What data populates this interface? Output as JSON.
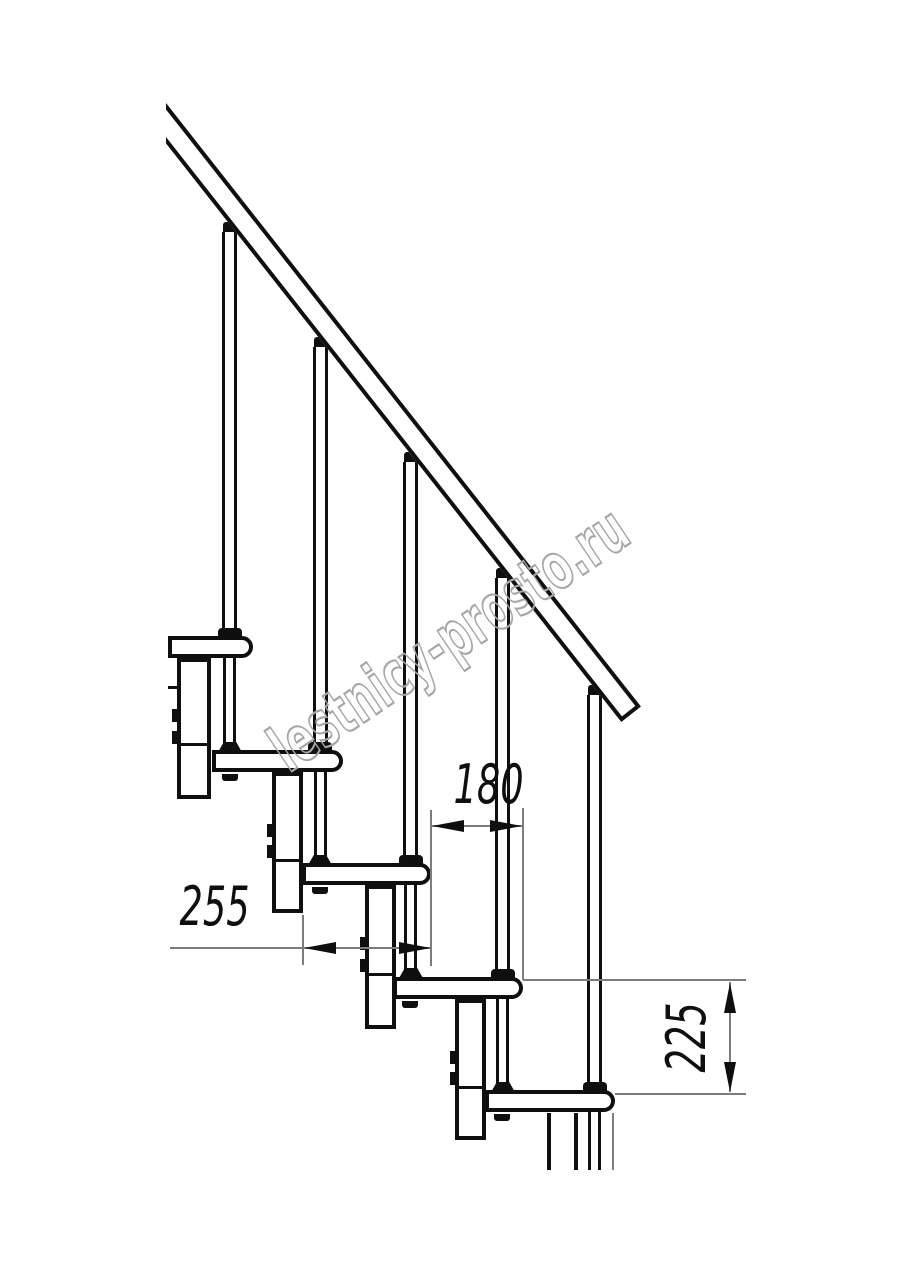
{
  "labels": {
    "dim_run": "180",
    "dim_depth": "255",
    "dim_rise": "225"
  },
  "watermark": {
    "text": "lestnicy-prosto.ru"
  },
  "colors": {
    "line": "#0f0f0f",
    "dim_line": "#7d7d7d",
    "watermark_outline": "#a6a6a6",
    "background": "#ffffff"
  }
}
